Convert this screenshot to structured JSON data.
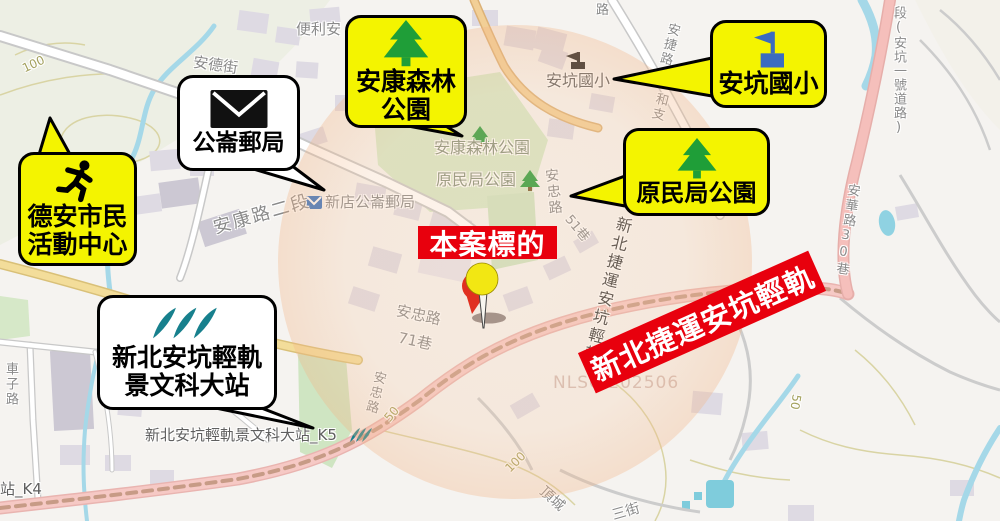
{
  "callouts": {
    "community_center": {
      "line1": "德安市民",
      "line2": "活動中心",
      "icon": "running-person"
    },
    "post_office": {
      "label": "公崙郵局",
      "icon": "envelope"
    },
    "forest_park": {
      "line1": "安康森林",
      "line2": "公園",
      "icon": "pine-tree"
    },
    "elementary_school": {
      "label": "安坑國小",
      "icon": "school-flag"
    },
    "aboriginal_park": {
      "label": "原民局公園",
      "icon": "pine-tree"
    },
    "lrt_station": {
      "line1": "新北安坑輕軌",
      "line2": "景文科大站",
      "icon": "metro-logo"
    }
  },
  "highlights": {
    "subject_label": "本案標的",
    "lrt_banner": "新北捷運安坑輕軌"
  },
  "map_labels": {
    "contour_100_tl": "100",
    "convenience": "便利安",
    "ande_street": "安德街",
    "ankang_road": "安康路二段",
    "post_office_map": "新店公崙郵局",
    "forest_park_map": "安康森林公園",
    "aboriginal_park_map": "原民局公園",
    "school_map": "安坑國小",
    "anjie_road": "安捷路",
    "road_partial": "路",
    "hezhi": "和支",
    "route_one": "段(安坑一號道路)",
    "anhua_lane": "安華路30巷",
    "anzhong_upper": "安忠路",
    "lane_51": "51巷",
    "rail_map_label": "新北捷運安坑輕軌",
    "anzhong_71_line1": "安忠路",
    "anzhong_71_line2": "71巷",
    "anzhong_lower": "安忠路",
    "contour_50_left": "50",
    "contour_100_bottom": "100",
    "contour_50_right": "50",
    "dingcheng": "頂城",
    "san_street": "三街",
    "chezi_road": "車子路",
    "station_k4": "站_K4",
    "station_k5": "新北安坑輕軌景文科大站_K5",
    "watermark": "NLSC 202506"
  },
  "colors": {
    "bubble_yellow": "#f4f400",
    "highlight_red": "#e8000d",
    "tree_green": "#1f9e38",
    "flag_blue": "#3b6cc0",
    "metro_teal": "#17808d",
    "rail_pink": "#f6c9c5",
    "water_blue": "#a5d8e8",
    "radius_orange": "#ec9664"
  }
}
